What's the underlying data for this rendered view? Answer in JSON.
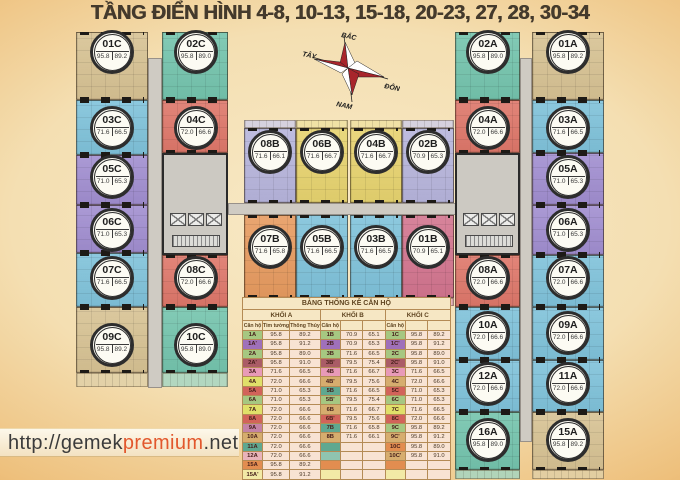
{
  "title": "TẦNG ĐIỂN HÌNH 4-8, 10-13, 15-18, 20-23, 27, 28, 30-34",
  "compass": {
    "north": "BẮC",
    "west": "TÂY",
    "east": "ĐÔNG",
    "south": "NAM"
  },
  "watermark": {
    "prefix": "http://gemek",
    "highlight": "premium",
    "suffix": ".net"
  },
  "units": [
    {
      "id": "01C",
      "tim": "95.8",
      "thong": "89.2",
      "color": "tan"
    },
    {
      "id": "02C",
      "tim": "95.8",
      "thong": "89.0",
      "color": "teal"
    },
    {
      "id": "03C",
      "tim": "71.6",
      "thong": "66.5",
      "color": "blue"
    },
    {
      "id": "04C",
      "tim": "72.0",
      "thong": "66.6",
      "color": "red"
    },
    {
      "id": "05C",
      "tim": "71.0",
      "thong": "65.3",
      "color": "purple"
    },
    {
      "id": "06C",
      "tim": "71.0",
      "thong": "65.3",
      "color": "purple"
    },
    {
      "id": "07C",
      "tim": "71.6",
      "thong": "66.5",
      "color": "blue"
    },
    {
      "id": "08C",
      "tim": "72.0",
      "thong": "66.6",
      "color": "red"
    },
    {
      "id": "09C",
      "tim": "95.8",
      "thong": "89.2",
      "color": "tan"
    },
    {
      "id": "10C",
      "tim": "95.8",
      "thong": "89.0",
      "color": "teal"
    },
    {
      "id": "08B",
      "tim": "71.6",
      "thong": "66.1",
      "color": "lavender"
    },
    {
      "id": "06B",
      "tim": "71.6",
      "thong": "66.7",
      "color": "yellow"
    },
    {
      "id": "04B",
      "tim": "71.6",
      "thong": "66.7",
      "color": "yellow"
    },
    {
      "id": "02B",
      "tim": "70.9",
      "thong": "65.3",
      "color": "lavender"
    },
    {
      "id": "07B",
      "tim": "71.6",
      "thong": "65.8",
      "color": "orange"
    },
    {
      "id": "05B",
      "tim": "71.6",
      "thong": "66.5",
      "color": "blue"
    },
    {
      "id": "03B",
      "tim": "71.6",
      "thong": "66.5",
      "color": "blue"
    },
    {
      "id": "01B",
      "tim": "70.9",
      "thong": "65.1",
      "color": "pink"
    },
    {
      "id": "02A",
      "tim": "95.8",
      "thong": "89.0",
      "color": "teal"
    },
    {
      "id": "01A",
      "tim": "95.8",
      "thong": "89.2",
      "color": "tan"
    },
    {
      "id": "04A",
      "tim": "72.0",
      "thong": "66.6",
      "color": "red"
    },
    {
      "id": "03A",
      "tim": "71.6",
      "thong": "66.5",
      "color": "blue"
    },
    {
      "id": "05A",
      "tim": "71.0",
      "thong": "65.3",
      "color": "purple"
    },
    {
      "id": "06A",
      "tim": "71.0",
      "thong": "65.3",
      "color": "purple"
    },
    {
      "id": "08A",
      "tim": "72.0",
      "thong": "66.6",
      "color": "red"
    },
    {
      "id": "07A",
      "tim": "72.0",
      "thong": "66.6",
      "color": "blue"
    },
    {
      "id": "10A",
      "tim": "72.0",
      "thong": "66.6",
      "color": "blue"
    },
    {
      "id": "09A",
      "tim": "72.0",
      "thong": "66.6",
      "color": "blue"
    },
    {
      "id": "12A",
      "tim": "72.0",
      "thong": "66.6",
      "color": "blue"
    },
    {
      "id": "11A",
      "tim": "72.0",
      "thong": "66.6",
      "color": "blue"
    },
    {
      "id": "16A",
      "tim": "95.8",
      "thong": "89.0",
      "color": "teal"
    },
    {
      "id": "15A",
      "tim": "95.8",
      "thong": "89.2",
      "color": "tan"
    }
  ],
  "table": {
    "title": "BẢNG THỐNG KÊ CĂN HỘ",
    "groups": [
      "KHỐI A",
      "KHỐI B",
      "KHỐI C"
    ],
    "subheaders": [
      "Căn hộ",
      "Tim tường",
      "Thông Thủy",
      "Căn hộ",
      "",
      "",
      "Căn hộ",
      "",
      ""
    ],
    "rows": [
      {
        "cells": [
          "1A",
          "95.8",
          "89.2",
          "1B",
          "70.9",
          "65.1",
          "1C",
          "95.8",
          "89.2"
        ],
        "colors": [
          "green",
          "green",
          "green"
        ]
      },
      {
        "cells": [
          "1A'",
          "95.8",
          "91.2",
          "2B",
          "70.9",
          "65.3",
          "1C'",
          "95.8",
          "91.2"
        ],
        "colors": [
          "purple",
          "purple",
          "purple"
        ]
      },
      {
        "cells": [
          "2A",
          "95.8",
          "89.0",
          "3B",
          "71.6",
          "66.5",
          "2C",
          "95.8",
          "89.0"
        ],
        "colors": [
          "green",
          "green",
          "green"
        ]
      },
      {
        "cells": [
          "2A'",
          "95.8",
          "91.0",
          "3B'",
          "79.5",
          "75.4",
          "2C'",
          "95.8",
          "91.0"
        ],
        "colors": [
          "maroon",
          "maroon",
          "maroon"
        ]
      },
      {
        "cells": [
          "3A",
          "71.6",
          "66.5",
          "4B",
          "71.6",
          "66.7",
          "3C",
          "71.6",
          "66.5"
        ],
        "colors": [
          "pink",
          "pink",
          "pink"
        ]
      },
      {
        "cells": [
          "4A",
          "72.0",
          "66.6",
          "4B'",
          "79.5",
          "75.6",
          "4C",
          "72.0",
          "66.6"
        ],
        "colors": [
          "yellow",
          "tan",
          "tan"
        ]
      },
      {
        "cells": [
          "5A",
          "71.0",
          "65.3",
          "5B",
          "71.6",
          "66.5",
          "5C",
          "71.0",
          "65.3"
        ],
        "colors": [
          "red",
          "teal",
          "red"
        ]
      },
      {
        "cells": [
          "6A",
          "71.0",
          "65.3",
          "5B'",
          "79.5",
          "75.4",
          "6C",
          "71.0",
          "65.3"
        ],
        "colors": [
          "green",
          "green",
          "green"
        ]
      },
      {
        "cells": [
          "7A",
          "72.0",
          "66.6",
          "6B",
          "71.6",
          "66.7",
          "7C",
          "71.6",
          "66.5"
        ],
        "colors": [
          "yellow",
          "tan",
          "yellow"
        ]
      },
      {
        "cells": [
          "8A",
          "72.0",
          "66.6",
          "6B'",
          "79.5",
          "75.6",
          "8C",
          "72.0",
          "66.6"
        ],
        "colors": [
          "red",
          "red",
          "red"
        ]
      },
      {
        "cells": [
          "9A",
          "72.0",
          "66.6",
          "7B",
          "71.6",
          "65.8",
          "9C",
          "95.8",
          "89.2"
        ],
        "colors": [
          "mauve",
          "teal",
          "green"
        ]
      },
      {
        "cells": [
          "10A",
          "72.0",
          "66.6",
          "8B",
          "71.6",
          "66.1",
          "9C'",
          "95.8",
          "91.2"
        ],
        "colors": [
          "tan",
          "tan",
          "tan"
        ]
      },
      {
        "cells": [
          "11A",
          "72.0",
          "66.6",
          "",
          "",
          "",
          "10C",
          "95.8",
          "89.0"
        ],
        "colors": [
          "teal",
          "teal",
          "orange"
        ]
      },
      {
        "cells": [
          "12A",
          "72.0",
          "66.6",
          "",
          "",
          "",
          "10C'",
          "95.8",
          "91.0"
        ],
        "colors": [
          "pinklt",
          "teallt",
          "tan"
        ]
      },
      {
        "cells": [
          "15A",
          "95.8",
          "89.2",
          "",
          "",
          "",
          "",
          "",
          ""
        ],
        "colors": [
          "orange",
          "orange",
          "orange"
        ]
      },
      {
        "cells": [
          "15A'",
          "95.8",
          "91.2",
          "",
          "",
          "",
          "",
          "",
          ""
        ],
        "colors": [
          "lty",
          "lty",
          "lty"
        ]
      },
      {
        "cells": [
          "16A",
          "95.8",
          "89.0",
          "",
          "",
          "",
          "",
          "",
          ""
        ],
        "colors": [
          "gold",
          "gold",
          "gold"
        ]
      },
      {
        "cells": [
          "",
          "",
          "",
          "",
          "",
          "",
          "",
          "",
          ""
        ],
        "colors": [
          "dred",
          "dred",
          "dred"
        ]
      }
    ]
  }
}
